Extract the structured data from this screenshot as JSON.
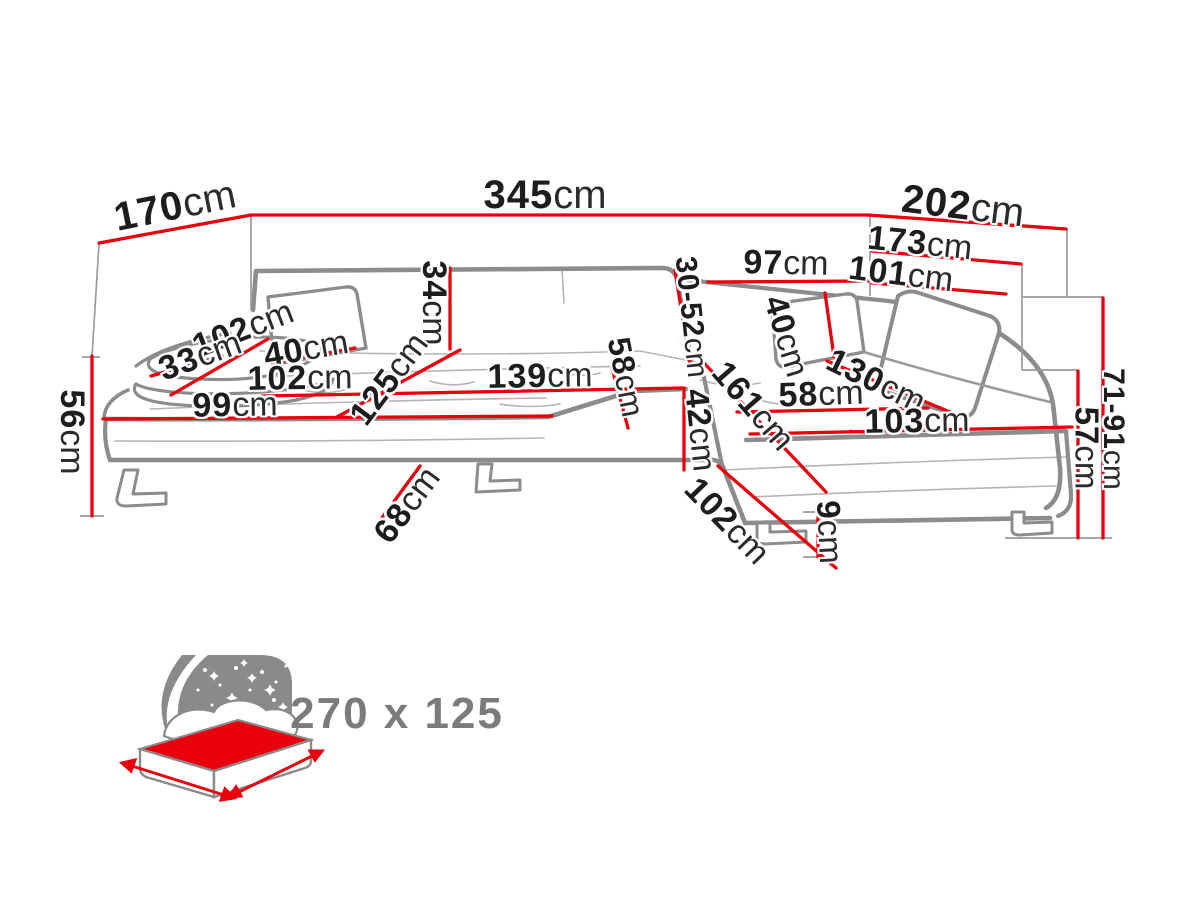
{
  "diagram": {
    "type": "sofa-dimension-diagram",
    "unit": "cm",
    "colors": {
      "dimension_line": "#e8000d",
      "sofa_outline": "#8c8c8c",
      "extension_line": "#9a9a9a",
      "label_text": "#1d1d1d",
      "icon_gray": "#8a8a8a",
      "bed_mattress": "#e8000d"
    },
    "dims": {
      "d170": {
        "value": "170",
        "unit": "cm"
      },
      "d345": {
        "value": "345",
        "unit": "cm"
      },
      "d202": {
        "value": "202",
        "unit": "cm"
      },
      "d173": {
        "value": "173",
        "unit": "cm"
      },
      "d97": {
        "value": "97",
        "unit": "cm"
      },
      "d101": {
        "value": "101",
        "unit": "cm"
      },
      "d102ul": {
        "value": "102",
        "unit": "cm"
      },
      "d33": {
        "value": "33",
        "unit": "cm"
      },
      "d40l": {
        "value": "40",
        "unit": "cm"
      },
      "d34": {
        "value": "34",
        "unit": "cm"
      },
      "d102l": {
        "value": "102",
        "unit": "cm"
      },
      "d99": {
        "value": "99",
        "unit": "cm"
      },
      "d125": {
        "value": "125",
        "unit": "cm"
      },
      "d139": {
        "value": "139",
        "unit": "cm"
      },
      "d58m": {
        "value": "58",
        "unit": "cm"
      },
      "d3052": {
        "value": "30-52",
        "unit": "cm"
      },
      "d40r": {
        "value": "40",
        "unit": "cm"
      },
      "d161": {
        "value": "161",
        "unit": "cm"
      },
      "d58r": {
        "value": "58",
        "unit": "cm"
      },
      "d130": {
        "value": "130",
        "unit": "cm"
      },
      "d103": {
        "value": "103",
        "unit": "cm"
      },
      "d42": {
        "value": "42",
        "unit": "cm"
      },
      "d56": {
        "value": "56",
        "unit": "cm"
      },
      "d68": {
        "value": "68",
        "unit": "cm"
      },
      "d102br": {
        "value": "102",
        "unit": "cm"
      },
      "d9": {
        "value": "9",
        "unit": "cm"
      },
      "d57": {
        "value": "57",
        "unit": "cm"
      },
      "d7191": {
        "value": "71-91",
        "unit": "cm"
      }
    },
    "sleep_icon": {
      "icon": "bed-icon",
      "size_label": "270 x 125"
    }
  }
}
